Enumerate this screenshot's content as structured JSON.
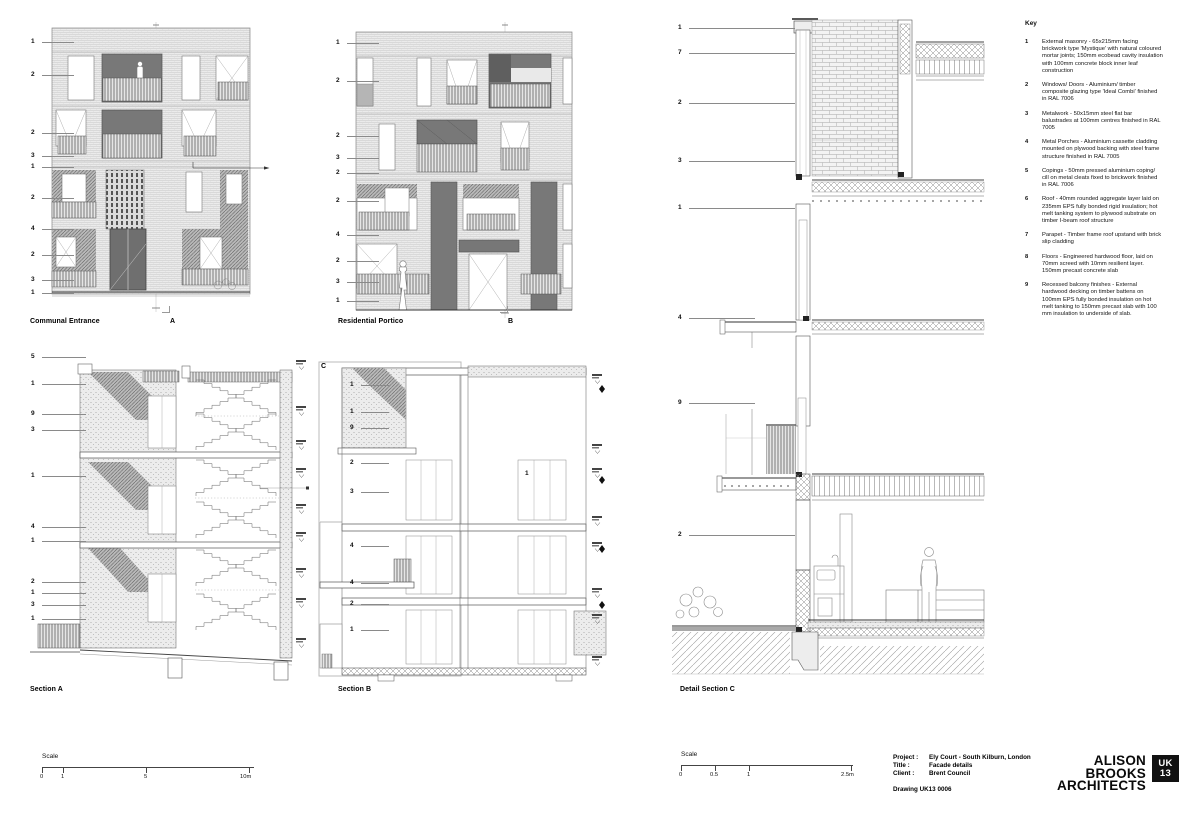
{
  "colors": {
    "ink": "#111111",
    "line_dark": "#444444",
    "line_mid": "#888888",
    "brick_light": "#ebebeb",
    "panel_dark": "#7d7d7d",
    "badge_bg": "#111111",
    "badge_fg": "#ffffff"
  },
  "drawings": {
    "elev_a": {
      "label": "Communal Entrance",
      "ref": "A",
      "callouts": [
        "1",
        "2",
        "2",
        "3",
        "1",
        "2",
        "4",
        "2",
        "3",
        "1"
      ]
    },
    "elev_b": {
      "label": "Residential Portico",
      "ref": "B",
      "callouts": [
        "1",
        "2",
        "2",
        "3",
        "2",
        "2",
        "4",
        "2",
        "3",
        "1"
      ]
    },
    "sec_a": {
      "label": "Section A",
      "callouts": [
        "5",
        "1",
        "9",
        "3",
        "1",
        "4",
        "1",
        "2",
        "1",
        "3",
        "1"
      ]
    },
    "sec_b": {
      "label": "Section B",
      "ref": "C",
      "callouts": [
        "1",
        "1",
        "9",
        "2",
        "3",
        "4",
        "4",
        "2",
        "1"
      ],
      "inline_callout": "1"
    },
    "det_c": {
      "label": "Detail Section C",
      "callouts": [
        "1",
        "7",
        "2",
        "3",
        "1",
        "4",
        "9",
        "2"
      ]
    }
  },
  "key": {
    "title": "Key",
    "items": [
      {
        "n": "1",
        "text": "External masonry - 65x215mm facing brickwork type 'Mystique' with natural coloured mortar joints; 150mm ecobead cavity insulation with 100mm concrete block inner leaf construction"
      },
      {
        "n": "2",
        "text": "Windows/ Doors - Aluminium/ timber composite glazing type 'Ideal Combi' finished in RAL 7006"
      },
      {
        "n": "3",
        "text": "Metalwork - 50x15mm steel flat bar balustrades at 100mm centres finished in RAL 7005"
      },
      {
        "n": "4",
        "text": "Metal Porches - Aluminium cassette cladding mounted on plywood backing with steel frame structure finished in RAL 7005"
      },
      {
        "n": "5",
        "text": "Copings - 50mm pressed aluminium coping/ cill on metal cleats fixed to brickwork finished in RAL 7006"
      },
      {
        "n": "6",
        "text": "Roof - 40mm rounded aggregate layer laid on 235mm EPS fully bonded rigid insulation; hot melt tanking system to plywood substrate on timber I-beam roof structure"
      },
      {
        "n": "7",
        "text": "Parapet - Timber frame roof upstand with brick slip cladding"
      },
      {
        "n": "8",
        "text": "Floors - Engineered hardwood floor, laid on 70mm screed with 10mm resilient layer. 150mm precast concrete slab"
      },
      {
        "n": "9",
        "text": "Recessed balcony finishes - External hardwood decking on timber battens on 100mm EPS fully bonded insulation on hot melt tanking to 150mm precast slab with 100 mm insulation to underside of slab."
      }
    ]
  },
  "scales": [
    {
      "label": "Scale",
      "ticks": [
        "0",
        "1",
        "5",
        "10m"
      ]
    },
    {
      "label": "Scale",
      "ticks": [
        "0",
        "0.5",
        "1",
        "2.5m"
      ]
    }
  ],
  "titleblock": {
    "project_label": "Project :",
    "project": "Ely Court  - South Kilburn, London",
    "title_label": "Title :",
    "title": "Facade details",
    "client_label": "Client :",
    "client": "Brent Council",
    "drawing": "Drawing UK13 0006",
    "firm_line1": "ALISON BROOKS",
    "firm_line2": "ARCHITECTS",
    "badge_line1": "UK",
    "badge_line2": "13"
  }
}
